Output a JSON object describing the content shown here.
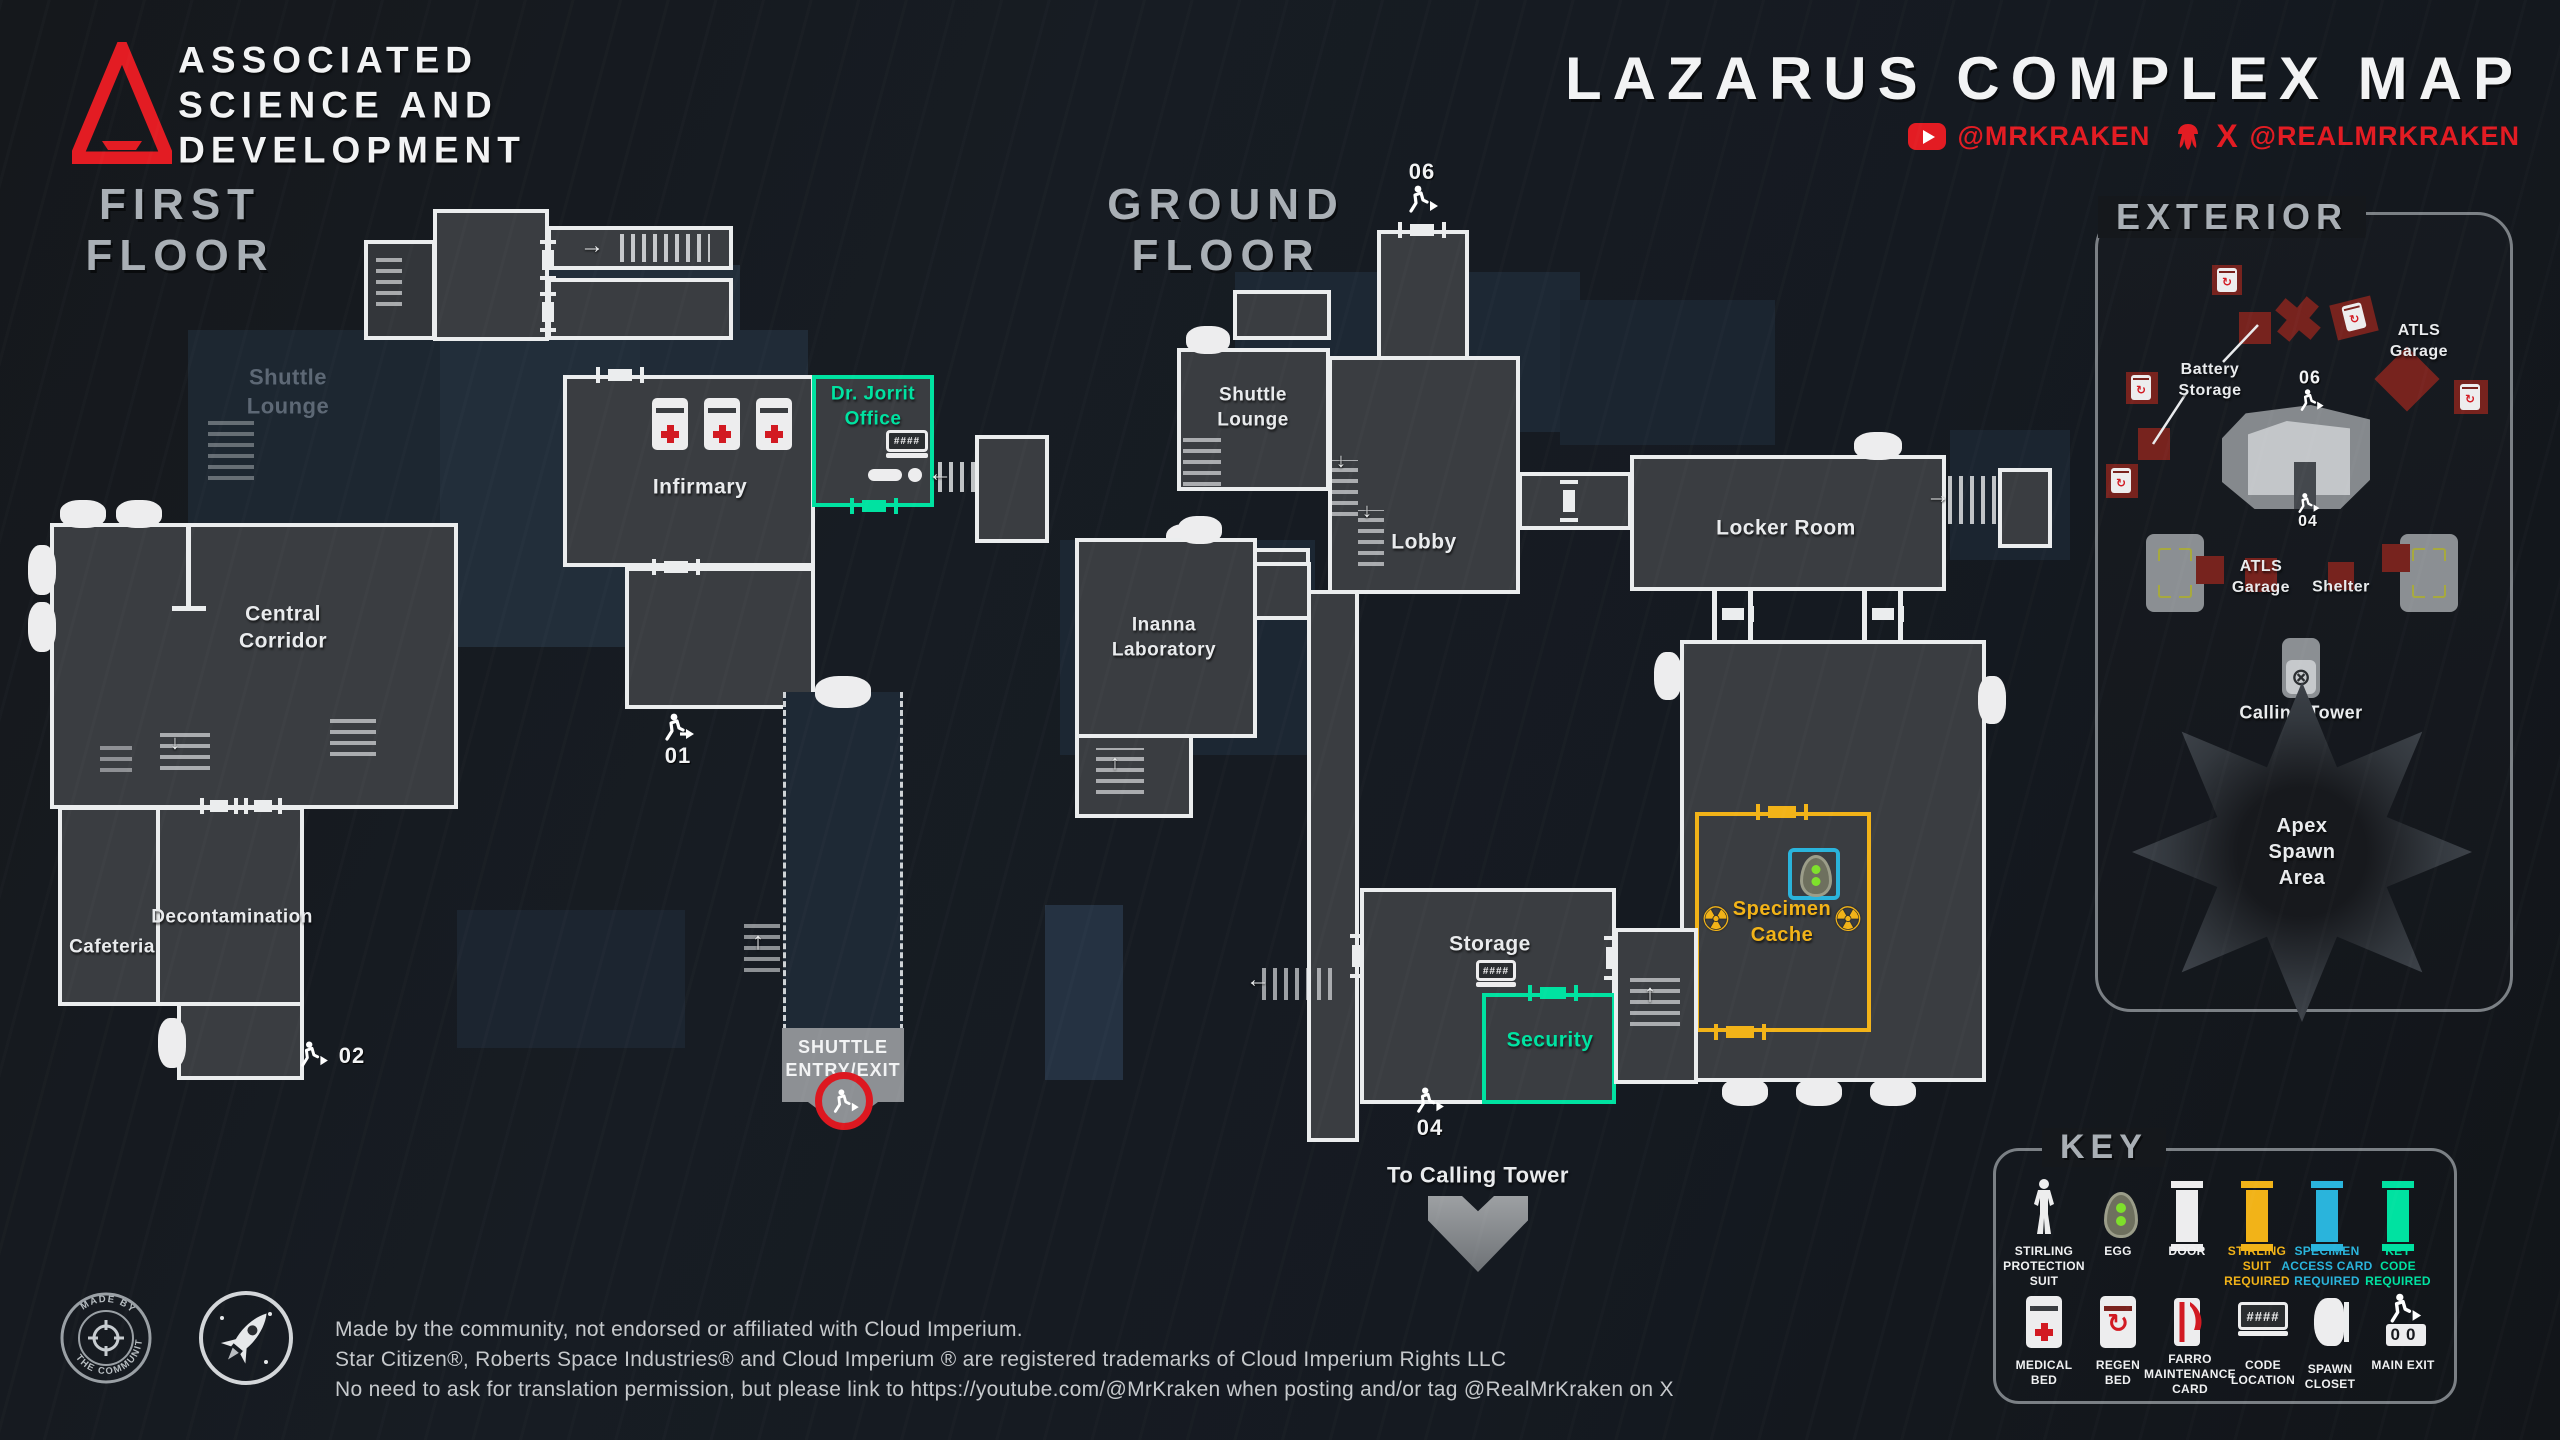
{
  "colors": {
    "accent_red": "#e31c23",
    "teal": "#00e2a1",
    "yellow": "#f2b318",
    "cyan": "#2ab4dc",
    "silver": "#a9afb5",
    "room_fill": "#3a3d41",
    "wall_white": "#ebedee",
    "exterior_block_red": "#77231e"
  },
  "icons": {
    "radiation": "☢",
    "regen": "↻",
    "calling_tower_glyph": "⊗",
    "stair_up": "↑",
    "stair_down": "↓",
    "stair_left": "←",
    "stair_right": "→"
  },
  "header": {
    "org_name": "ASSOCIATED\nSCIENCE AND\nDEVELOPMENT",
    "title": "LAZARUS COMPLEX MAP",
    "youtube_handle": "@MRKRAKEN",
    "x_logo": "X",
    "x_handle": "@REALMRKRAKEN"
  },
  "first_floor": {
    "title": "FIRST\nFLOOR",
    "shuttle_lounge": "Shuttle\nLounge",
    "central_corridor": "Central\nCorridor",
    "cafeteria": "Cafeteria",
    "decontamination": "Decontamination",
    "infirmary": "Infirmary",
    "dr_jorrit_office": "Dr. Jorrit\nOffice",
    "exit_01": "01",
    "exit_02": "02",
    "shuttle_entry": "SHUTTLE\nENTRY/EXIT"
  },
  "ground_floor": {
    "title": "GROUND\nFLOOR",
    "shuttle_lounge": "Shuttle\nLounge",
    "lobby": "Lobby",
    "inanna_laboratory": "Inanna\nLaboratory",
    "locker_room": "Locker Room",
    "storage": "Storage",
    "security": "Security",
    "specimen_cache": "Specimen\nCache",
    "exit_04": "04",
    "exit_06": "06",
    "to_calling_tower": "To Calling Tower"
  },
  "exterior": {
    "title": "EXTERIOR",
    "battery_storage": "Battery\nStorage",
    "atls_garage_top": "ATLS\nGarage",
    "atls_garage_bottom": "ATLS\nGarage",
    "shelter": "Shelter",
    "calling_tower": "Calling Tower",
    "apex_spawn_area": "Apex\nSpawn\nArea",
    "exit_04": "04",
    "exit_06": "06"
  },
  "key": {
    "title": "KEY",
    "code_icon_text": "####",
    "main_exit_digits": "00",
    "items": [
      {
        "label": "STIRLING\nPROTECTION\nSUIT"
      },
      {
        "label": "EGG"
      },
      {
        "label": "DOOR"
      },
      {
        "label": "STIRLING\nSUIT\nREQUIRED"
      },
      {
        "label": "SPECIMEN\nACCESS CARD\nREQUIRED"
      },
      {
        "label": "KEY\nCODE\nREQUIRED"
      },
      {
        "label": "MEDICAL\nBED"
      },
      {
        "label": "REGEN\nBED"
      },
      {
        "label": "FARRO\nMAINTENANCE\nCARD"
      },
      {
        "label": "CODE\nLOCATION"
      },
      {
        "label": "SPAWN\nCLOSET"
      },
      {
        "label": "MAIN EXIT"
      }
    ]
  },
  "badges": {
    "community_top": "MADE BY",
    "community_bottom": "THE COMMUNITY"
  },
  "footer": {
    "line1": "Made by the community, not endorsed or affiliated with Cloud Imperium.",
    "line2": "Star Citizen®, Roberts Space Industries® and Cloud Imperium ® are registered trademarks of Cloud Imperium Rights LLC",
    "line3": "No need to ask for translation permission, but please link to https://youtube.com/@MrKraken when posting and/or tag @RealMrKraken on X"
  }
}
